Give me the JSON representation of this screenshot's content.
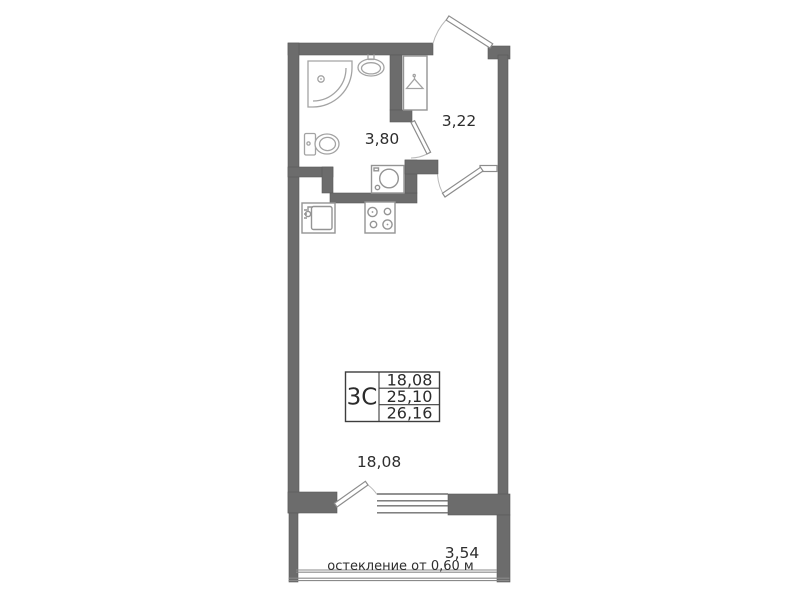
{
  "plan": {
    "areas": {
      "bathroom": "3,80",
      "hall": "3,22",
      "living_room": "18,08",
      "balcony": "3,54"
    },
    "info_table": {
      "unit_type": "3С",
      "values": [
        "18,08",
        "25,10",
        "26,16"
      ]
    },
    "balcony_note": "остекление от 0,60 м",
    "colors": {
      "wall": "#6c6c6c",
      "fixture_line": "#a3a3a3",
      "text": "#2e2e2e"
    }
  }
}
